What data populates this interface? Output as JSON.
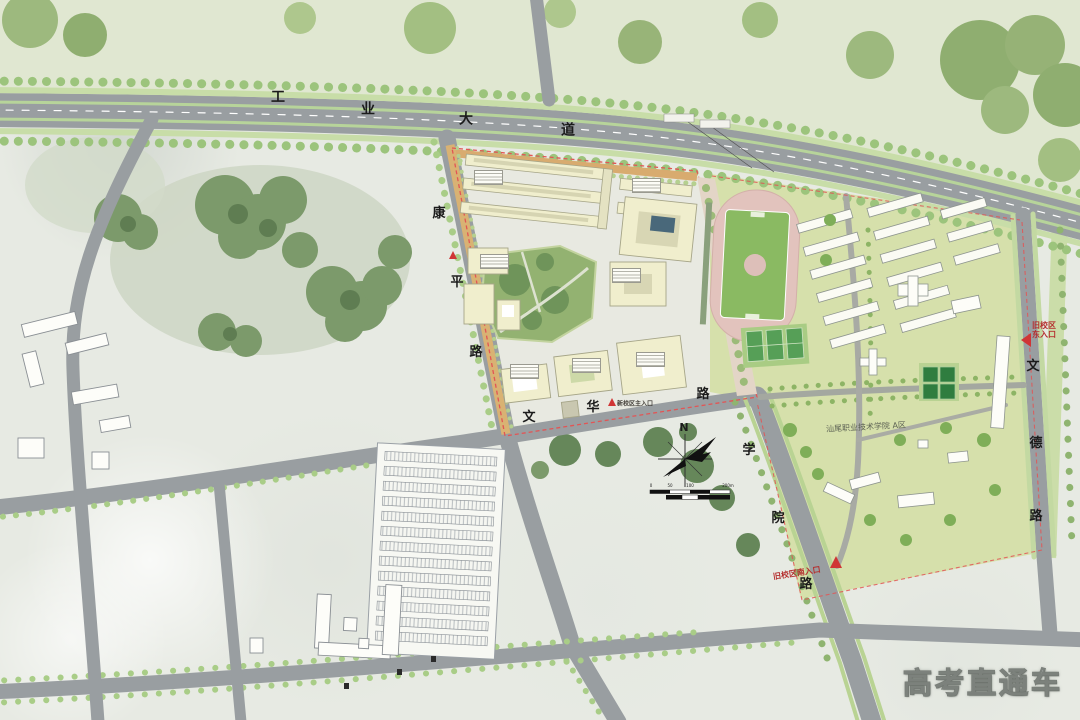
{
  "watermark": "高考直通车",
  "compass": {
    "north": "N"
  },
  "roads": {
    "industrial": {
      "name": "工业大道",
      "chars": [
        "工",
        "业",
        "大",
        "道"
      ]
    },
    "kangping": {
      "name": "康平路",
      "chars": [
        "康",
        "平",
        "路"
      ]
    },
    "wenhua": {
      "name": "文华路",
      "chars": [
        "文",
        "华",
        "路"
      ]
    },
    "xueyuan": {
      "name": "学院路",
      "chars": [
        "学",
        "院",
        "路"
      ]
    },
    "wende": {
      "name": "文德路",
      "chars": [
        "文",
        "德",
        "路"
      ]
    }
  },
  "labels": {
    "campus_area": "汕尾职业技术学院 A区",
    "east_entrance": [
      "旧校区",
      "东入口"
    ],
    "south_entrance": "旧校区南入口",
    "main_entrance": "新校区主入口",
    "scale_bar": [
      "0",
      "50",
      "100",
      "200m"
    ]
  },
  "colors": {
    "road_gray": "#999ea1",
    "campus_building_cream": "#f0eecd",
    "courtyard_green": "#93b271",
    "old_campus_bg": "#d6e0ab",
    "track_pink": "#e2c3bd",
    "field_green": "#8aba62",
    "boundary_red": "#e25555",
    "entrance_red": "#b52f2f"
  }
}
